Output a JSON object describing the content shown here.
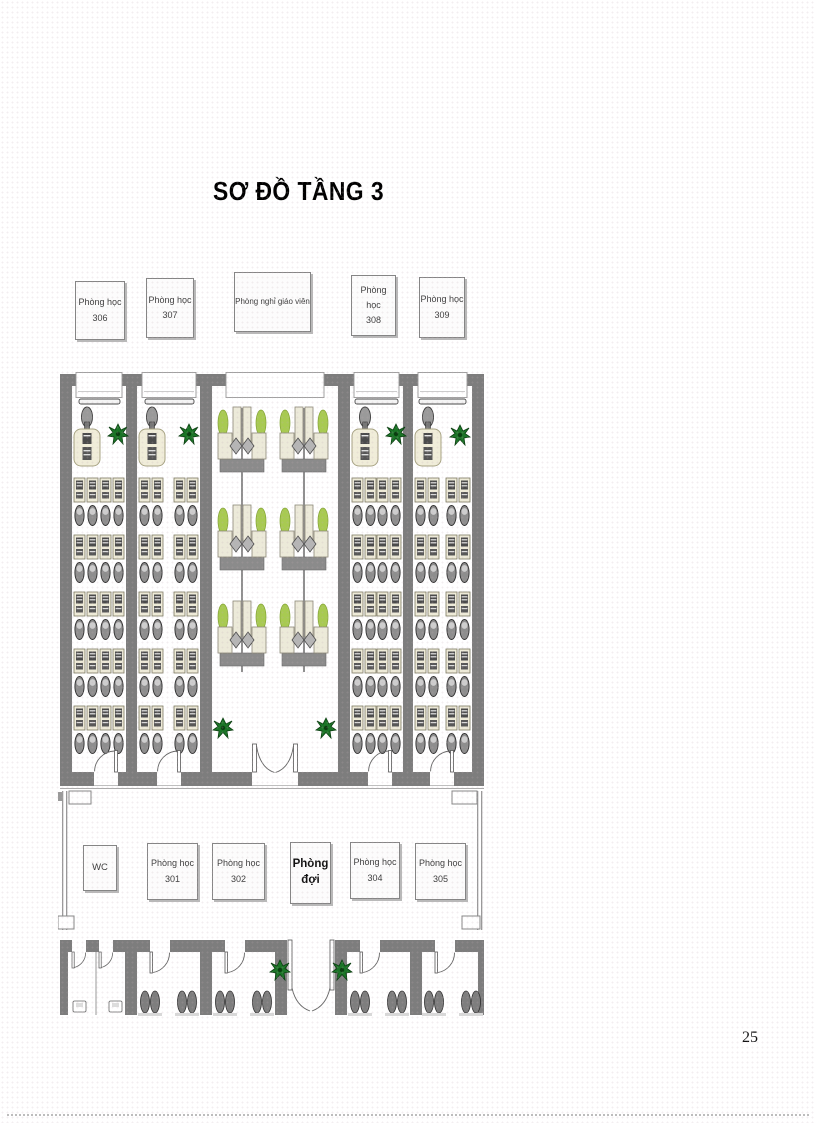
{
  "title": "SƠ ĐỒ TẦNG 3",
  "page_number": "25",
  "top_labels": [
    {
      "line1": "Phòng học",
      "line2": "306"
    },
    {
      "line1": "Phòng học",
      "line2": "307"
    },
    {
      "line1": "Phòng nghỉ giáo viên",
      "line2": ""
    },
    {
      "line1": "Phòng học",
      "line2": "308"
    },
    {
      "line1": "Phòng học",
      "line2": "309"
    }
  ],
  "corridor_labels": [
    {
      "line1": "WC",
      "line2": ""
    },
    {
      "line1": "Phòng học",
      "line2": "301"
    },
    {
      "line1": "Phòng học",
      "line2": "302"
    },
    {
      "line1": "Phòng",
      "line2": "đợi"
    },
    {
      "line1": "Phòng học",
      "line2": "304"
    },
    {
      "line1": "Phòng học",
      "line2": "305"
    }
  ],
  "colors": {
    "wall": "#7d7d7d",
    "floor": "#ffffff",
    "desk": "#eeebd8",
    "chair": "#8e8e8e",
    "plant_dark": "#1b7527",
    "plant_light": "#a8ca52",
    "label_border": "#858585",
    "label_shadow": "#b9b9b9"
  }
}
